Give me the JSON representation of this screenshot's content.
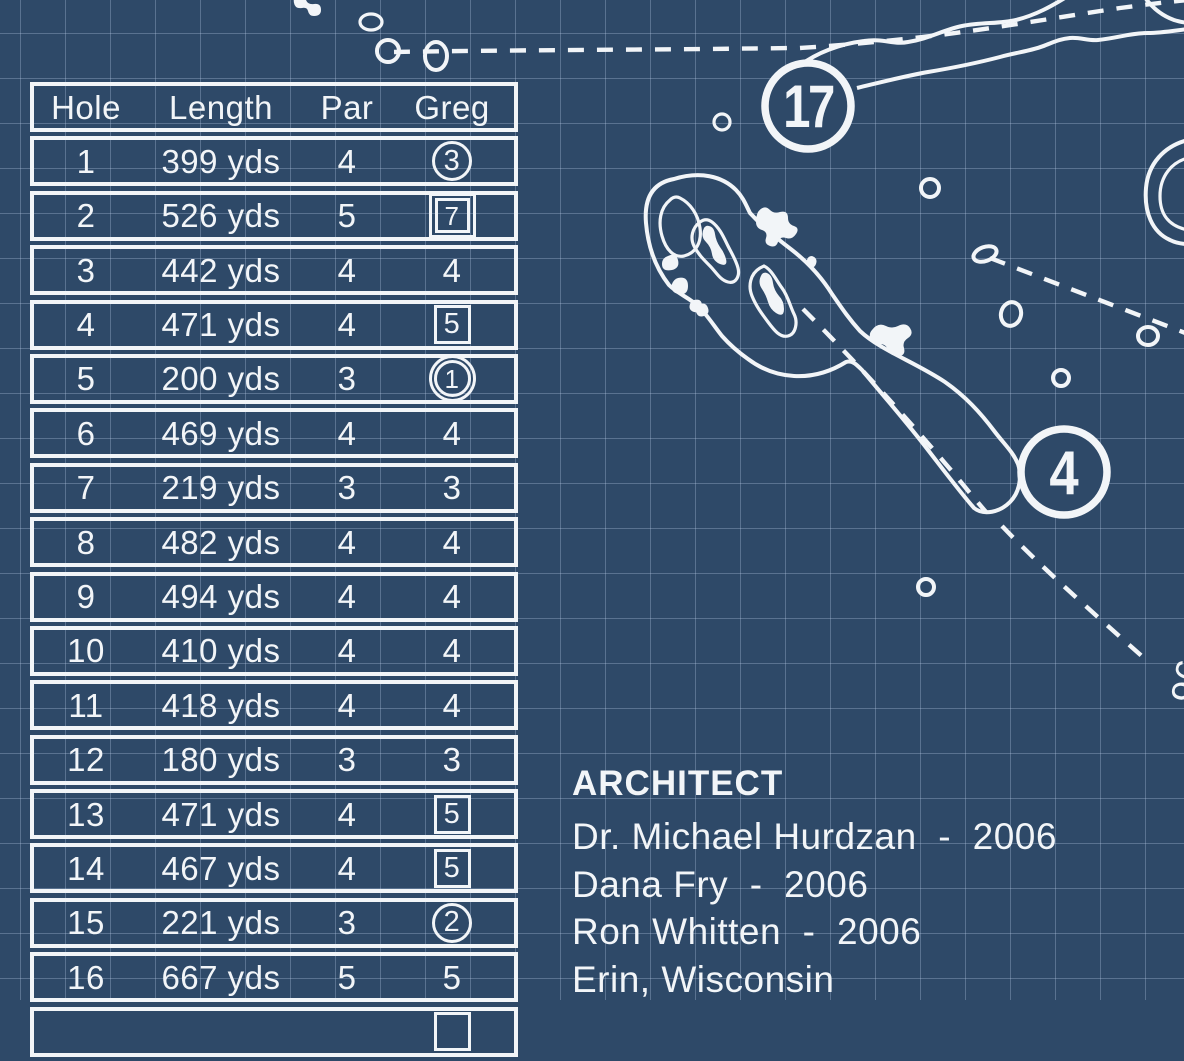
{
  "theme": {
    "background": "#2e4968",
    "grid_line": "rgba(190,210,235,0.30)",
    "ink": "#f2f5f8"
  },
  "scorecard": {
    "headers": [
      "Hole",
      "Length",
      "Par",
      "Greg"
    ],
    "rows": [
      {
        "hole": "1",
        "length": "399 yds",
        "par": "4",
        "greg": "3",
        "marker": "circle"
      },
      {
        "hole": "2",
        "length": "526 yds",
        "par": "5",
        "greg": "7",
        "marker": "double-square"
      },
      {
        "hole": "3",
        "length": "442 yds",
        "par": "4",
        "greg": "4",
        "marker": "none"
      },
      {
        "hole": "4",
        "length": "471 yds",
        "par": "4",
        "greg": "5",
        "marker": "square"
      },
      {
        "hole": "5",
        "length": "200 yds",
        "par": "3",
        "greg": "1",
        "marker": "double-circle"
      },
      {
        "hole": "6",
        "length": "469 yds",
        "par": "4",
        "greg": "4",
        "marker": "none"
      },
      {
        "hole": "7",
        "length": "219 yds",
        "par": "3",
        "greg": "3",
        "marker": "none"
      },
      {
        "hole": "8",
        "length": "482 yds",
        "par": "4",
        "greg": "4",
        "marker": "none"
      },
      {
        "hole": "9",
        "length": "494 yds",
        "par": "4",
        "greg": "4",
        "marker": "none"
      },
      {
        "hole": "10",
        "length": "410 yds",
        "par": "4",
        "greg": "4",
        "marker": "none"
      },
      {
        "hole": "11",
        "length": "418 yds",
        "par": "4",
        "greg": "4",
        "marker": "none"
      },
      {
        "hole": "12",
        "length": "180 yds",
        "par": "3",
        "greg": "3",
        "marker": "none"
      },
      {
        "hole": "13",
        "length": "471 yds",
        "par": "4",
        "greg": "5",
        "marker": "square"
      },
      {
        "hole": "14",
        "length": "467 yds",
        "par": "4",
        "greg": "5",
        "marker": "square"
      },
      {
        "hole": "15",
        "length": "221 yds",
        "par": "3",
        "greg": "2",
        "marker": "circle"
      },
      {
        "hole": "16",
        "length": "667 yds",
        "par": "5",
        "greg": "5",
        "marker": "none"
      },
      {
        "hole": "",
        "length": "",
        "par": "",
        "greg": "",
        "marker": "square"
      }
    ]
  },
  "architect": {
    "heading": "ARCHITECT",
    "credits": [
      "Dr. Michael Hurdzan  -  2006",
      "Dana Fry  -  2006",
      "Ron Whitten  -  2006",
      "Erin, Wisconsin"
    ]
  },
  "map": {
    "hole_badges": [
      {
        "label": "17"
      },
      {
        "label": "4"
      }
    ],
    "yardage_label": "96"
  }
}
